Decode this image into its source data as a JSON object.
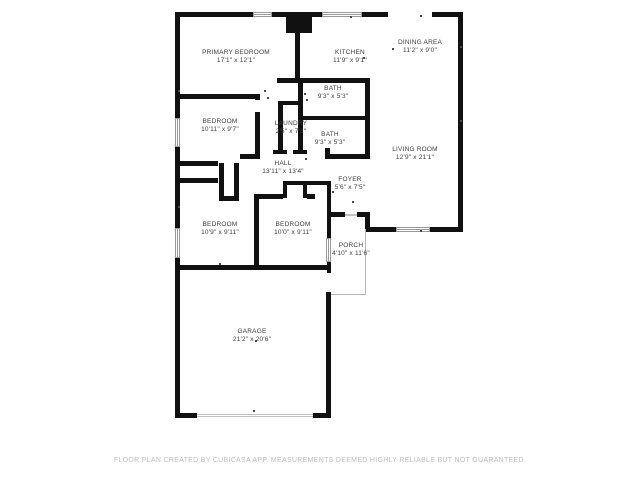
{
  "footer": "FLOOR PLAN CREATED BY CUBICASA APP. MEASUREMENTS DEEMED HIGHLY RELIABLE BUT NOT GUARANTEED.",
  "colors": {
    "wall": "#111111",
    "label": "#3e3e3e",
    "footer_text": "#bdbdbd",
    "window_line": "#999999",
    "background": "#ffffff"
  },
  "rooms": [
    {
      "id": "primary-bedroom",
      "name": "PRIMARY BEDROOM",
      "dims": "17'1\" x 12'1\"",
      "cx": 236,
      "y": 49
    },
    {
      "id": "kitchen",
      "name": "KITCHEN",
      "dims": "11'9\" x 9'1\"",
      "cx": 350,
      "y": 49
    },
    {
      "id": "dining-area",
      "name": "DINING AREA",
      "dims": "11'2\" x 9'0\"",
      "cx": 420,
      "y": 39
    },
    {
      "id": "bath-upper",
      "name": "BATH",
      "dims": "9'3\" x 5'3\"",
      "cx": 333,
      "y": 85
    },
    {
      "id": "bedroom-upper",
      "name": "BEDROOM",
      "dims": "10'11\" x 9'7\"",
      "cx": 220,
      "y": 118
    },
    {
      "id": "laundry",
      "name": "LAUNDRY",
      "dims": "2'5\" x 7'1\"",
      "cx": 291,
      "y": 120
    },
    {
      "id": "bath-lower",
      "name": "BATH",
      "dims": "9'3\" x 5'3\"",
      "cx": 330,
      "y": 131
    },
    {
      "id": "living-room",
      "name": "LIVING ROOM",
      "dims": "12'9\" x 21'1\"",
      "cx": 415,
      "y": 146
    },
    {
      "id": "hall",
      "name": "HALL",
      "dims": "13'11\" x 13'4\"",
      "cx": 283,
      "y": 160
    },
    {
      "id": "foyer",
      "name": "FOYER",
      "dims": "5'6\" x 7'5\"",
      "cx": 350,
      "y": 176
    },
    {
      "id": "bedroom-left",
      "name": "BEDROOM",
      "dims": "10'9\" x 9'11\"",
      "cx": 220,
      "y": 221
    },
    {
      "id": "bedroom-right",
      "name": "BEDROOM",
      "dims": "10'0\" x 9'11\"",
      "cx": 293,
      "y": 221
    },
    {
      "id": "porch",
      "name": "PORCH",
      "dims": "4'10\" x 11'6\"",
      "cx": 351,
      "y": 242
    },
    {
      "id": "garage",
      "name": "GARAGE",
      "dims": "21'2\" x 20'6\"",
      "cx": 252,
      "y": 328
    }
  ],
  "geometry": {
    "walls": [
      [
        175,
        12,
        78,
        5
      ],
      [
        272,
        12,
        14,
        5
      ],
      [
        312,
        12,
        10,
        5
      ],
      [
        362,
        12,
        26,
        5
      ],
      [
        432,
        12,
        31,
        5
      ],
      [
        286,
        12,
        26,
        21
      ],
      [
        458,
        12,
        5,
        220
      ],
      [
        175,
        12,
        5,
        106
      ],
      [
        175,
        147,
        5,
        81
      ],
      [
        175,
        258,
        5,
        160
      ],
      [
        366,
        227,
        30,
        5
      ],
      [
        430,
        227,
        33,
        5
      ],
      [
        365,
        212,
        5,
        17
      ],
      [
        331,
        212,
        14,
        5
      ],
      [
        357,
        212,
        9,
        5
      ],
      [
        180,
        265,
        151,
        5
      ],
      [
        326,
        292,
        5,
        126
      ],
      [
        175,
        413,
        22,
        5
      ],
      [
        313,
        413,
        18,
        5
      ],
      [
        295,
        33,
        5,
        45
      ],
      [
        277,
        78,
        93,
        5
      ],
      [
        365,
        83,
        5,
        71
      ],
      [
        303,
        116,
        62,
        4
      ],
      [
        298,
        83,
        5,
        71
      ],
      [
        280,
        101,
        23,
        4
      ],
      [
        278,
        101,
        5,
        53
      ],
      [
        273,
        150,
        14,
        4
      ],
      [
        293,
        150,
        14,
        4
      ],
      [
        325,
        148,
        5,
        6
      ],
      [
        325,
        154,
        45,
        5
      ],
      [
        240,
        154,
        19,
        5
      ],
      [
        255,
        94,
        5,
        6
      ],
      [
        255,
        112,
        5,
        47
      ],
      [
        180,
        94,
        80,
        5
      ],
      [
        180,
        161,
        38,
        5
      ],
      [
        180,
        178,
        38,
        5
      ],
      [
        219,
        163,
        5,
        34
      ],
      [
        234,
        163,
        5,
        34
      ],
      [
        219,
        196,
        20,
        5
      ],
      [
        254,
        194,
        5,
        71
      ],
      [
        259,
        194,
        24,
        5
      ],
      [
        307,
        194,
        8,
        5
      ],
      [
        283,
        181,
        48,
        4
      ],
      [
        283,
        181,
        4,
        17
      ],
      [
        303,
        181,
        4,
        17
      ],
      [
        327,
        185,
        4,
        53
      ],
      [
        327,
        262,
        4,
        11
      ]
    ],
    "windows_h": [
      [
        253,
        12,
        19,
        5
      ],
      [
        322,
        12,
        40,
        5
      ],
      [
        396,
        227,
        34,
        5
      ]
    ],
    "windows_v": [
      [
        175,
        118,
        5,
        29
      ],
      [
        175,
        228,
        5,
        30
      ],
      [
        326,
        238,
        5,
        24
      ]
    ],
    "door_lines": [
      [
        345,
        214,
        12,
        2
      ],
      [
        197,
        414,
        116,
        1
      ],
      [
        197,
        416,
        116,
        1
      ]
    ],
    "porch_lines": [
      [
        365,
        229,
        1,
        66
      ],
      [
        331,
        294,
        35,
        1
      ]
    ],
    "ticks": [
      [
        264,
        90
      ],
      [
        267,
        97
      ],
      [
        304,
        93
      ],
      [
        306,
        99
      ],
      [
        350,
        16
      ],
      [
        420,
        15
      ],
      [
        392,
        48
      ],
      [
        363,
        57
      ],
      [
        332,
        191
      ],
      [
        352,
        201
      ],
      [
        420,
        230
      ],
      [
        305,
        158
      ],
      [
        219,
        263
      ],
      [
        255,
        340
      ],
      [
        460,
        120
      ],
      [
        460,
        46
      ],
      [
        178,
        90
      ],
      [
        178,
        206
      ],
      [
        253,
        410
      ]
    ]
  }
}
